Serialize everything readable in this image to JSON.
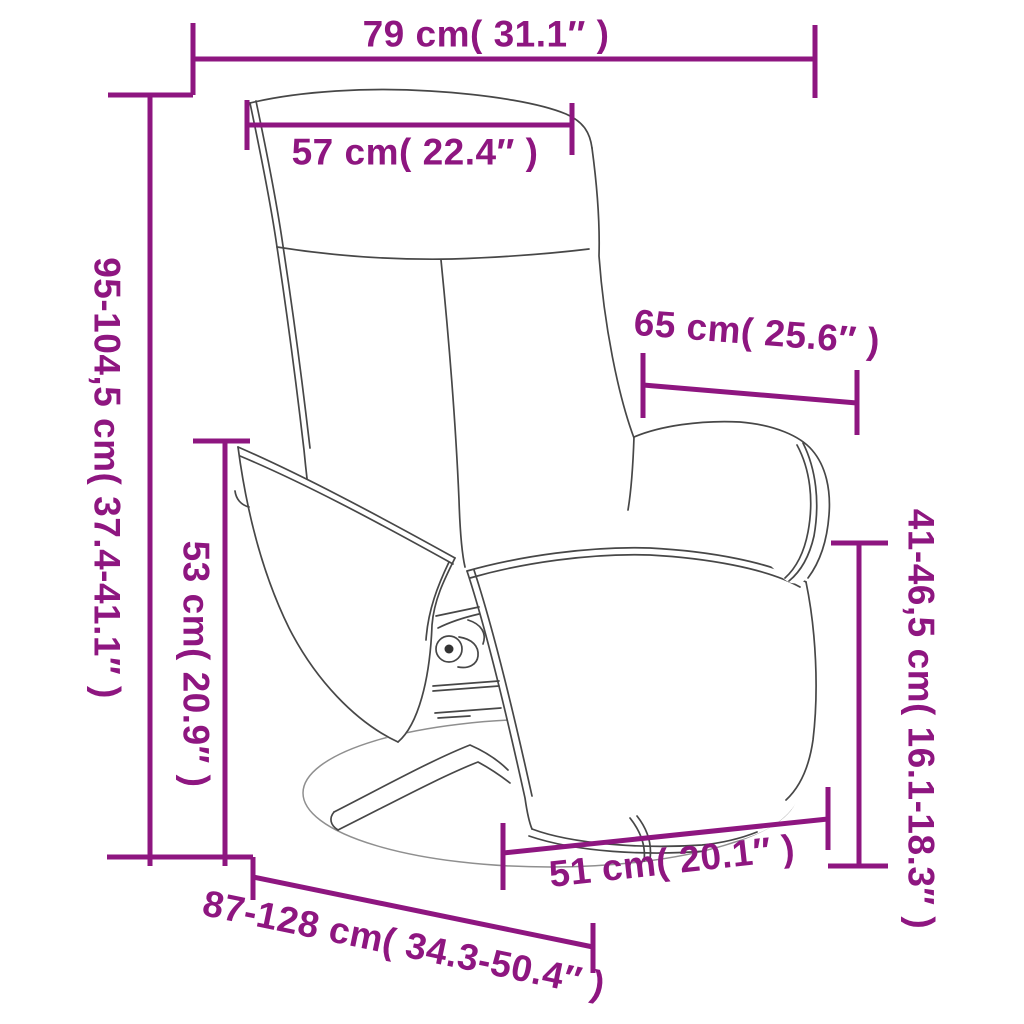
{
  "figure": {
    "type": "product-dimension-diagram",
    "product": "swivel recliner chair with footrest base (line drawing)",
    "colors": {
      "dimension_accent": "#8E1680",
      "chair_outline": "#474747",
      "background": "#ffffff"
    },
    "dimensions": {
      "overall_width": {
        "label": "79 cm( 31.1″ )"
      },
      "backrest_width": {
        "label": "57 cm( 22.4″ )"
      },
      "overall_height": {
        "label": "95-104,5 cm( 37.4-41.1″ )"
      },
      "seat_height": {
        "label": "53 cm( 20.9″ )"
      },
      "backrest_depth": {
        "label": "65 cm( 25.6″ )"
      },
      "armrest_height": {
        "label": "41-46,5 cm( 16.1-18.3″ )"
      },
      "base_width": {
        "label": "51 cm( 20.1″ )"
      },
      "overall_depth": {
        "label": "87-128 cm( 34.3-50.4″ )"
      }
    }
  }
}
